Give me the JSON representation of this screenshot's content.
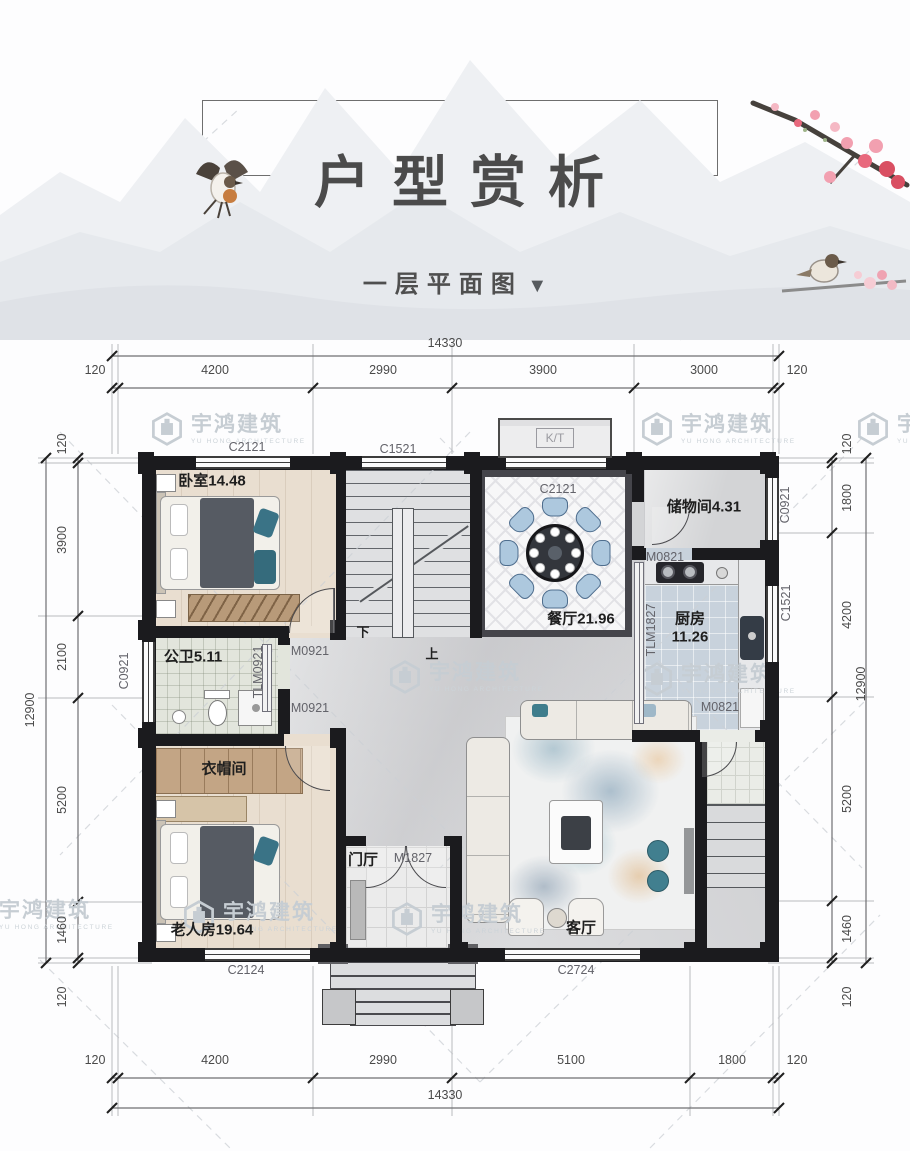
{
  "header": {
    "title": "户型赏析",
    "subtitle": "一层平面图",
    "arrow": "▼"
  },
  "watermark": {
    "text": "宇鸿建筑",
    "subtext": "YU HONG ARCHITECTURE"
  },
  "rooms": {
    "bedroom": "卧室14.48",
    "bathroom": "公卫5.11",
    "cloakroom": "衣帽间",
    "elder": "老人房19.64",
    "foyer": "门厅",
    "living": "客厅",
    "dining": "餐厅21.96",
    "storage": "储物间4.31",
    "kitchen_name": "厨房",
    "kitchen_area": "11.26"
  },
  "stairs": {
    "down": "下",
    "up": "上"
  },
  "openings": {
    "c2121_top": "C2121",
    "c1521_top": "C1521",
    "kt": "K/T",
    "c2121_dining": "C2121",
    "c0921_right": "C0921",
    "c1521_right": "C1521",
    "c0921_left": "C0921",
    "c2124_bottom": "C2124",
    "c2724_bottom": "C2724",
    "m0921_upper": "M0921",
    "m0921_lower": "M0921",
    "m0821_storage": "M0821",
    "m0821_kitchen": "M0821",
    "tlm1827": "TLM1827",
    "tlm0921": "TLM0921",
    "m1827": "M1827"
  },
  "dimensions": {
    "top": {
      "overall": "14330",
      "segments": [
        "120",
        "4200",
        "2990",
        "3900",
        "3000",
        "120"
      ]
    },
    "bottom": {
      "overall": "14330",
      "segments": [
        "120",
        "4200",
        "2990",
        "5100",
        "1800",
        "120"
      ]
    },
    "left": {
      "overall": "12900",
      "segments": [
        "120",
        "3900",
        "2100",
        "5200",
        "1460",
        "120"
      ]
    },
    "right": {
      "overall": "12900",
      "segments": [
        "120",
        "1800",
        "4200",
        "5200",
        "1460",
        "120"
      ]
    }
  }
}
